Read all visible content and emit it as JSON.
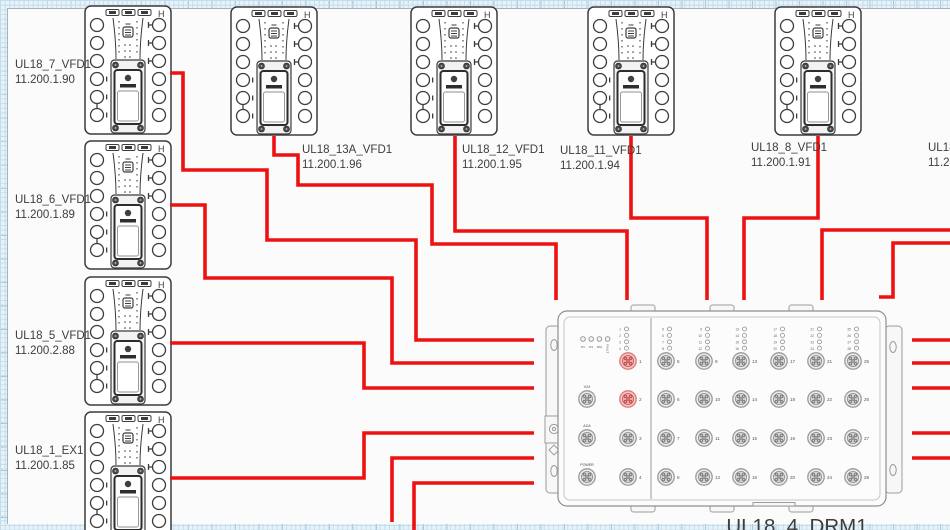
{
  "canvas": {
    "width": 950,
    "height": 530
  },
  "colors": {
    "cable": "#ee1111",
    "device_stroke": "#3c3c3c",
    "drm_stroke": "#909090",
    "port_ring": "#9a9a9a",
    "port_fill": "#ececec",
    "highlight_ring": "#db7a7a",
    "highlight_fill": "#f7c6c6",
    "label_text": "#3d3d3d",
    "grid_line": "#c3ddeb",
    "sheet": "#fbfbfc"
  },
  "vfd": {
    "h_mark": "H"
  },
  "devices": [
    {
      "name": "UL18_7_VFD1",
      "ip": "11.200.1.90",
      "x": 84,
      "y": 5,
      "label_x": 15,
      "label_y": 58
    },
    {
      "name": "UL18_6_VFD1",
      "ip": "11.200.1.89",
      "x": 84,
      "y": 140,
      "label_x": 15,
      "label_y": 193
    },
    {
      "name": "UL18_5_VFD1",
      "ip": "11.200.2.88",
      "x": 84,
      "y": 276,
      "label_x": 15,
      "label_y": 329
    },
    {
      "name": "UL18_1_EX1",
      "ip": "11.200.1.85",
      "x": 84,
      "y": 411,
      "label_x": 15,
      "label_y": 444
    },
    {
      "name": "UL18_13A_VFD1",
      "ip": "11.200.1.96",
      "x": 230,
      "y": 6,
      "label_x": 302,
      "label_y": 143
    },
    {
      "name": "UL18_12_VFD1",
      "ip": "11.200.1.95",
      "x": 410,
      "y": 6,
      "label_x": 462,
      "label_y": 143
    },
    {
      "name": "UL18_11_VFD1",
      "ip": "11.200.1.94",
      "x": 587,
      "y": 6,
      "label_x": 560,
      "label_y": 144
    },
    {
      "name": "UL18_8_VFD1",
      "ip": "11.200.1.91",
      "x": 774,
      "y": 6,
      "label_x": 751,
      "label_y": 141
    },
    {
      "name": "UL18",
      "ip": "11.20",
      "x": 962,
      "y": 6,
      "label_x": 928,
      "label_y": 141
    }
  ],
  "drm": {
    "label": "UL18_4_DRM1",
    "status_leds": [
      "P1",
      "P2",
      "RM",
      "FAULT"
    ],
    "aux_ports": [
      "V24",
      "ACA",
      "POWER"
    ],
    "left_ports": [
      1,
      2,
      3,
      4
    ],
    "highlighted_ports": [
      1,
      2
    ],
    "led_groups": [
      [
        1,
        2,
        3,
        4
      ],
      [
        5,
        6,
        7,
        8
      ],
      [
        9,
        10,
        11,
        12
      ],
      [
        13,
        14,
        15,
        16
      ],
      [
        17,
        18,
        19,
        20
      ],
      [
        21,
        22,
        23,
        24
      ],
      [
        25,
        26,
        27,
        28
      ]
    ],
    "port_rows": [
      [
        5,
        9,
        13,
        17,
        21,
        25
      ],
      [
        6,
        10,
        14,
        18,
        22,
        26
      ],
      [
        7,
        11,
        15,
        19,
        23,
        27
      ],
      [
        8,
        12,
        16,
        20,
        24,
        28
      ]
    ]
  },
  "cables": [
    {
      "name": "ul18_7-to-drm",
      "points": [
        [
          170,
          73
        ],
        [
          183,
          73
        ],
        [
          183,
          170
        ],
        [
          267,
          170
        ],
        [
          267,
          240
        ],
        [
          416,
          240
        ],
        [
          416,
          340
        ],
        [
          534,
          340
        ]
      ]
    },
    {
      "name": "ul18_6-to-drm",
      "points": [
        [
          170,
          205
        ],
        [
          205,
          205
        ],
        [
          205,
          278
        ],
        [
          392,
          278
        ],
        [
          392,
          363
        ],
        [
          534,
          363
        ]
      ]
    },
    {
      "name": "ul18_5-to-drm",
      "points": [
        [
          170,
          343
        ],
        [
          364,
          343
        ],
        [
          364,
          388
        ],
        [
          534,
          388
        ]
      ]
    },
    {
      "name": "ul18_1-to-drm",
      "points": [
        [
          170,
          478
        ],
        [
          364,
          478
        ],
        [
          364,
          433
        ],
        [
          534,
          433
        ]
      ]
    },
    {
      "name": "drm-to-bottom-1",
      "points": [
        [
          534,
          458
        ],
        [
          392,
          458
        ],
        [
          392,
          522
        ]
      ]
    },
    {
      "name": "drm-to-bottom-2",
      "points": [
        [
          534,
          483
        ],
        [
          414,
          483
        ],
        [
          414,
          531
        ]
      ]
    },
    {
      "name": "ul18_13a-to-drm",
      "points": [
        [
          274,
          136
        ],
        [
          274,
          155
        ],
        [
          298,
          155
        ],
        [
          298,
          185
        ],
        [
          432,
          185
        ],
        [
          432,
          244
        ],
        [
          556,
          244
        ],
        [
          556,
          300
        ]
      ]
    },
    {
      "name": "ul18_12-to-drm",
      "points": [
        [
          455,
          136
        ],
        [
          455,
          231
        ],
        [
          627,
          231
        ],
        [
          627,
          300
        ]
      ]
    },
    {
      "name": "ul18_11-to-drm",
      "points": [
        [
          631,
          136
        ],
        [
          631,
          218
        ],
        [
          707,
          218
        ],
        [
          707,
          300
        ]
      ]
    },
    {
      "name": "ul18_8-to-drm",
      "points": [
        [
          818,
          136
        ],
        [
          818,
          218
        ],
        [
          744,
          218
        ],
        [
          744,
          300
        ]
      ]
    },
    {
      "name": "right-to-drm-top-1",
      "points": [
        [
          951,
          230
        ],
        [
          822,
          230
        ],
        [
          822,
          300
        ]
      ]
    },
    {
      "name": "right-to-drm-top-2",
      "points": [
        [
          951,
          243
        ],
        [
          893,
          243
        ],
        [
          893,
          297
        ],
        [
          879,
          297
        ]
      ]
    },
    {
      "name": "drm-right-1",
      "points": [
        [
          912,
          340
        ],
        [
          951,
          340
        ]
      ]
    },
    {
      "name": "drm-right-2",
      "points": [
        [
          912,
          363
        ],
        [
          951,
          363
        ]
      ]
    },
    {
      "name": "drm-right-3",
      "points": [
        [
          912,
          388
        ],
        [
          951,
          388
        ]
      ]
    },
    {
      "name": "drm-right-4",
      "points": [
        [
          912,
          433
        ],
        [
          951,
          433
        ]
      ]
    },
    {
      "name": "drm-right-5",
      "points": [
        [
          912,
          458
        ],
        [
          951,
          458
        ]
      ]
    }
  ]
}
